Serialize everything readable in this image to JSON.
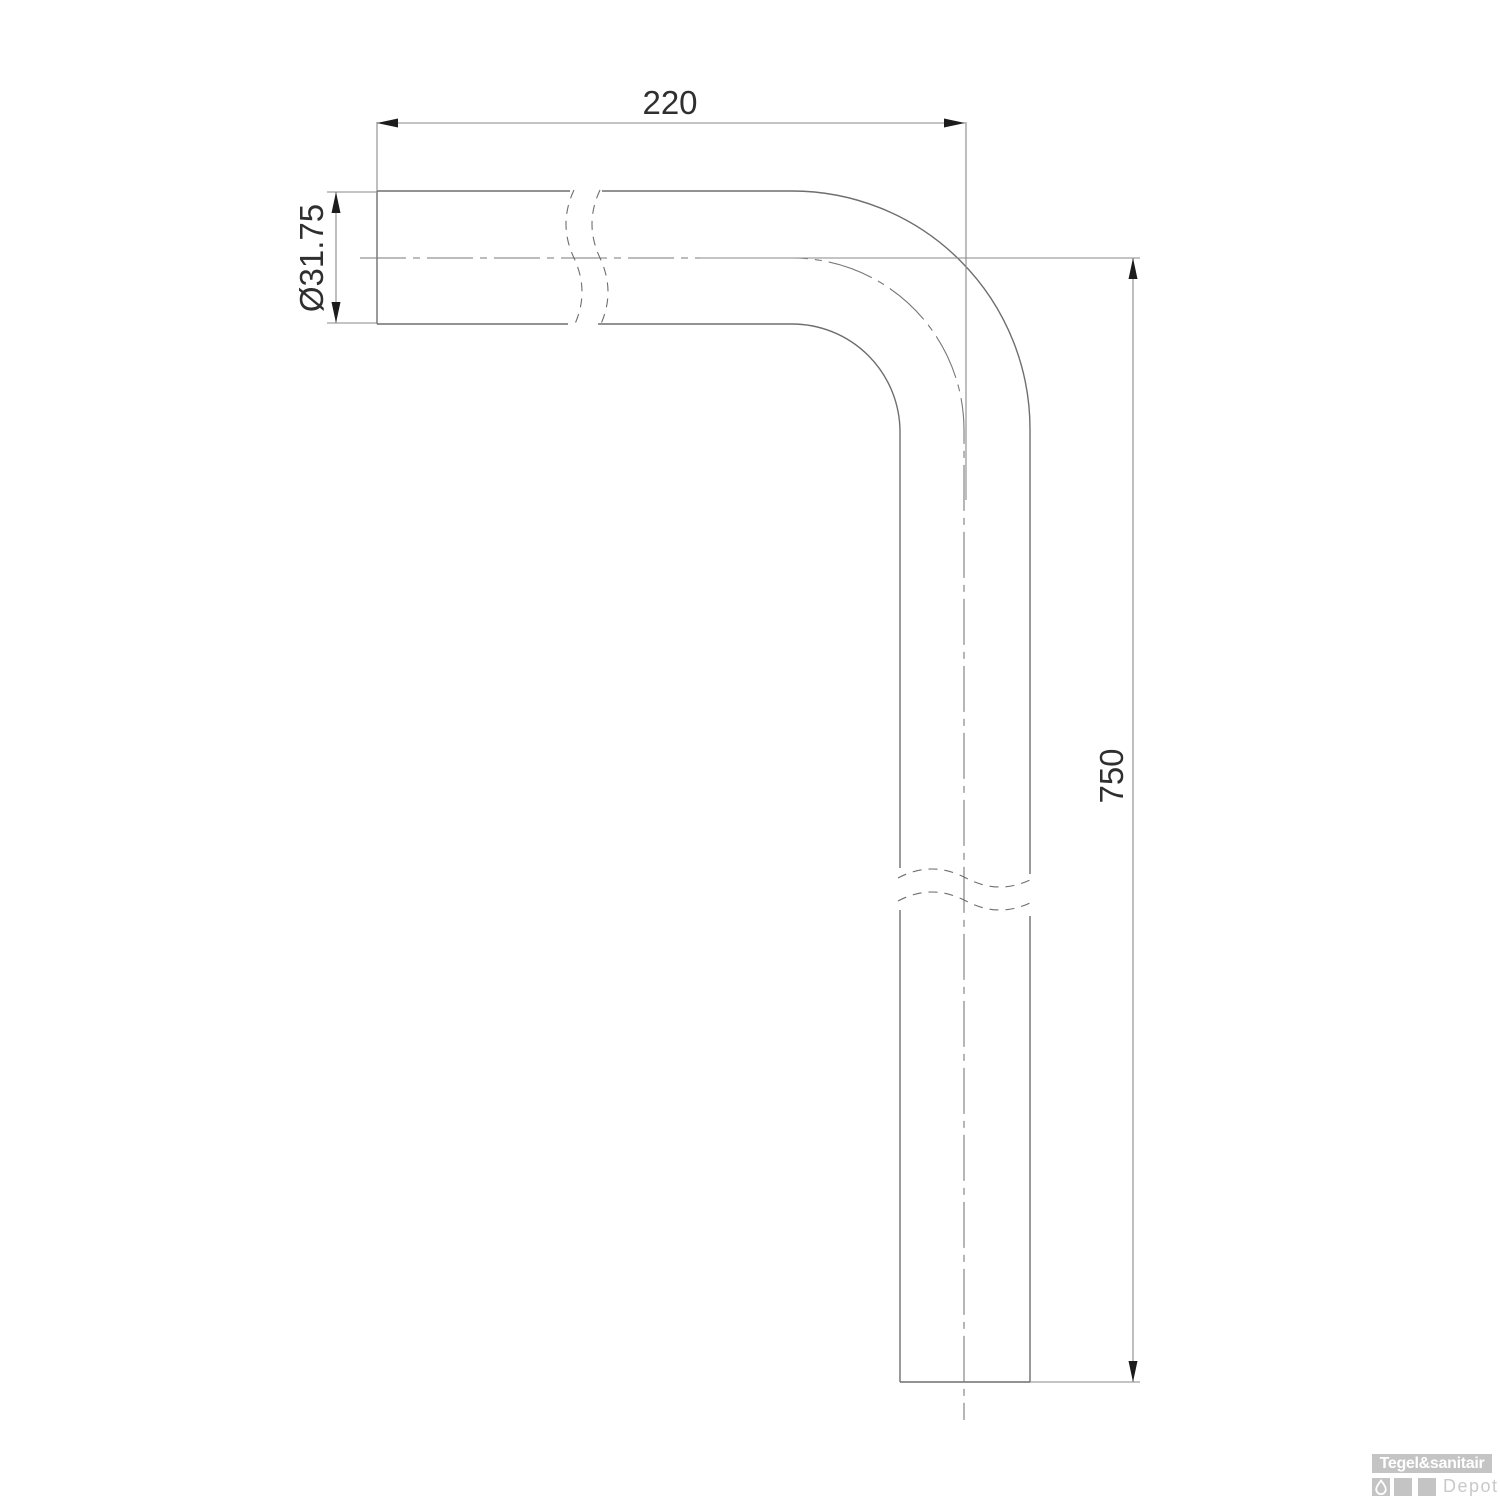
{
  "drawing": {
    "type": "technical-drawing",
    "subject": "90-degree pipe bend (flush pipe elbow)",
    "dimensions": {
      "width_label": "220",
      "diameter_label": "Ø31.75",
      "height_label": "750"
    }
  },
  "watermark": {
    "brand_bold": "Tegel&sanitair",
    "brand_light": "Depot",
    "icon": "water-drop-icon"
  },
  "colors": {
    "background": "#ffffff",
    "pipe_outline": "#6e6e6e",
    "dimension_line": "#8a8a8a",
    "centerline": "#7a7a7a",
    "arrow": "#1c1c1c",
    "label_text": "#2f2f2f",
    "watermark_gray": "#c4c4c4",
    "watermark_brand_text": "#ffffff",
    "watermark_light_text": "#c9c9c9"
  }
}
